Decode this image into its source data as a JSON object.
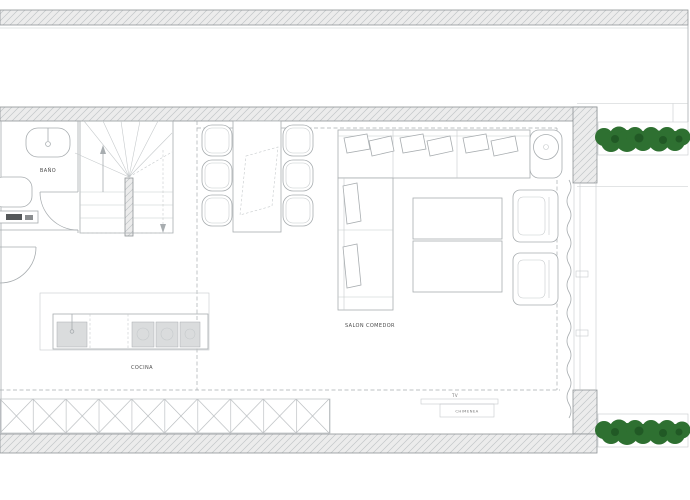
{
  "plan": {
    "type": "architectural-floor-plan",
    "rooms": {
      "bathroom": {
        "label": "BAÑO"
      },
      "kitchen": {
        "label": "COCINA"
      },
      "living_dining": {
        "label": "SALON COMEDOR"
      },
      "tv": {
        "label": "TV"
      },
      "fireplace": {
        "label": "CHIMENEA"
      }
    },
    "colors": {
      "line": "#a8adb0",
      "line_light": "#c6cacc",
      "line_dark": "#8e9396",
      "wall_fill": "#ececec",
      "hatch_line": "#c2c6c8",
      "fixture_fill": "#dadcdd",
      "hedge_green": "#2e7031",
      "hedge_dark": "#1e5523",
      "label_text": "#4b4b4b"
    }
  }
}
